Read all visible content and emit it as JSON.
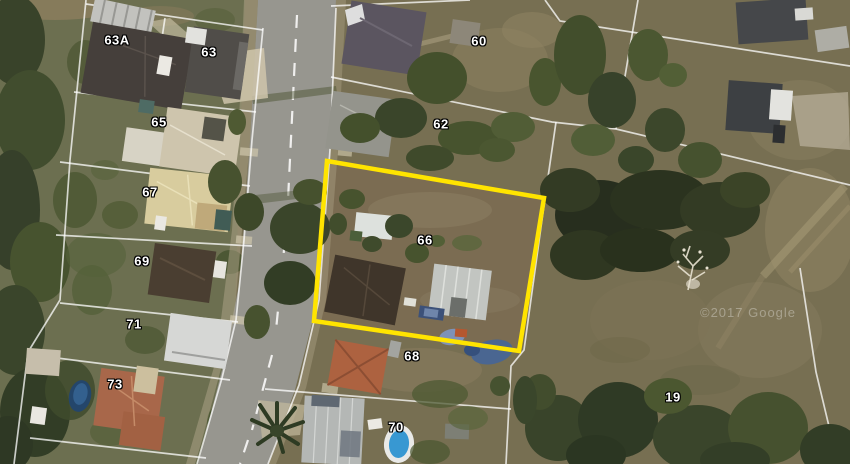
{
  "map": {
    "type": "satellite-aerial-view",
    "watermark": "©2017 Google"
  },
  "highlight": {
    "lot": "66",
    "color": "#ffe400",
    "points": "327,161 544,198 519,351 314,321"
  },
  "lots": [
    {
      "label": "63A",
      "x": 117,
      "y": 40
    },
    {
      "label": "63",
      "x": 209,
      "y": 52
    },
    {
      "label": "65",
      "x": 159,
      "y": 122
    },
    {
      "label": "67",
      "x": 150,
      "y": 192
    },
    {
      "label": "69",
      "x": 142,
      "y": 261
    },
    {
      "label": "71",
      "x": 134,
      "y": 324
    },
    {
      "label": "73",
      "x": 115,
      "y": 384
    },
    {
      "label": "60",
      "x": 479,
      "y": 41
    },
    {
      "label": "62",
      "x": 441,
      "y": 124
    },
    {
      "label": "66",
      "x": 425,
      "y": 240
    },
    {
      "label": "68",
      "x": 412,
      "y": 356
    },
    {
      "label": "70",
      "x": 396,
      "y": 427
    },
    {
      "label": "19",
      "x": 673,
      "y": 397
    }
  ],
  "colors": {
    "highlight_boundary": "#ffe400",
    "parcel_lines": "#ffffff",
    "label_text": "#ffffff",
    "label_outline": "#000000",
    "road": "#97968f",
    "field": "#776f52",
    "vegetation": "#3c472b"
  }
}
